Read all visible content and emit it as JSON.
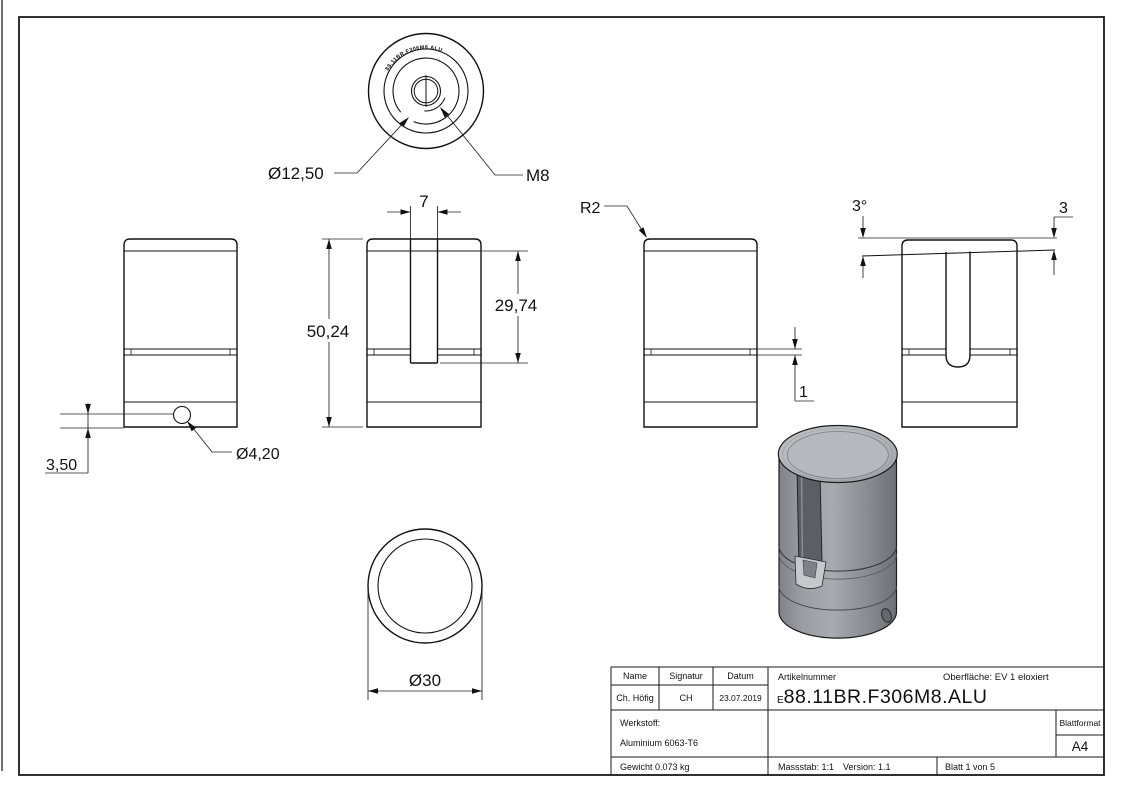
{
  "dims": {
    "top_counterbore": "Ø12,50",
    "top_thread": "M8",
    "slot_width": "7",
    "overall_height": "50,24",
    "slot_depth": "29,74",
    "hole_offset": "3,50",
    "hole_diameter": "Ø4,20",
    "cap_radius": "R2",
    "groove_width": "1",
    "top_angle": "3°",
    "top_drop": "3",
    "outer_diameter": "Ø30"
  },
  "engraving": "88.11BR.F306M8.ALU",
  "title_block": {
    "name_label": "Name",
    "signature_label": "Signatur",
    "date_label": "Datum",
    "name": "Ch. Höfig",
    "signature": "CH",
    "date": "23.07.2019",
    "article_label": "Artikelnummer",
    "article_prefix": "E",
    "article_number": "88.11BR.F306M8.ALU",
    "surface": "Oberfläche:  EV 1 eloxiert",
    "material_label": "Werkstoff:",
    "material": "Aluminium 6063-T6",
    "weight": "Gewicht 0.073 kg",
    "scale": "Massstab: 1:1",
    "version": "Version: 1.1",
    "sheet": "Blatt 1 von 5",
    "format_label": "Blattformat",
    "format": "A4"
  }
}
